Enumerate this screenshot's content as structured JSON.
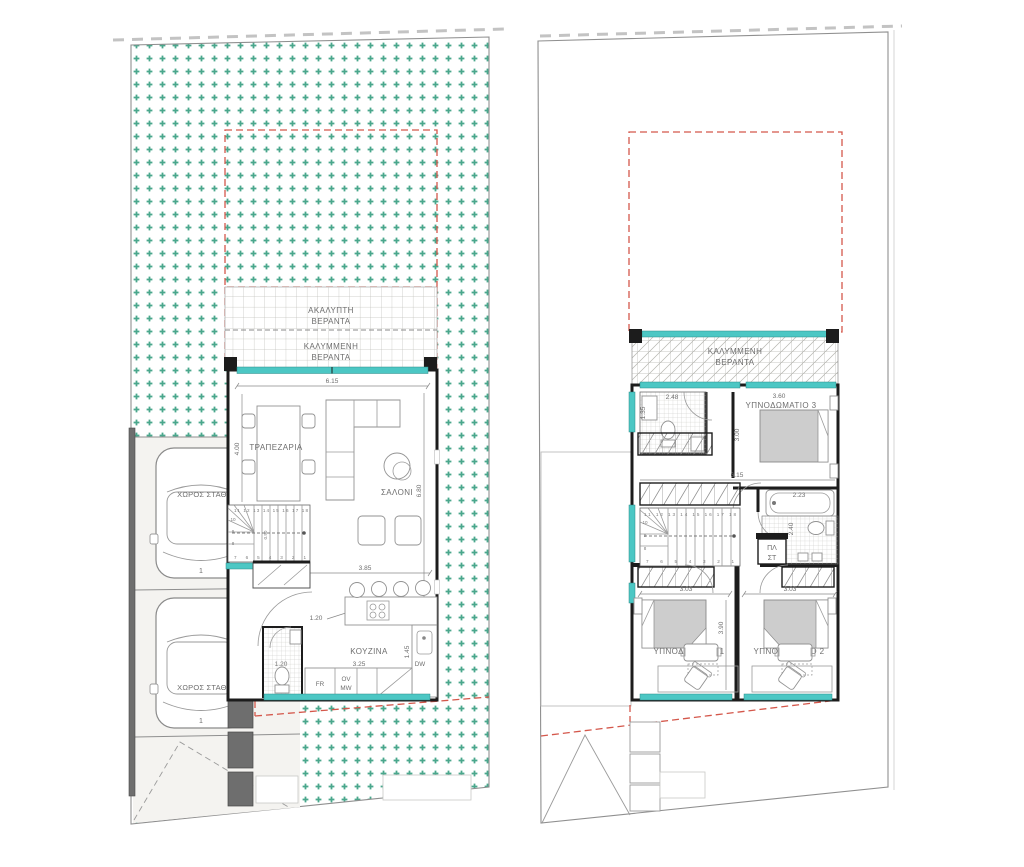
{
  "colors": {
    "garden_dots": "#4aa78c",
    "glazing_teal": "#4cc7c4",
    "upper_floor_outline_red": "#d4574b",
    "walls_black": "#1c1c1c",
    "boundary_wall_gray": "#6e6e6e"
  },
  "ground_floor": {
    "veranda_uncovered": [
      "ΑΚΑΛΥΠΤΗ",
      "ΒΕΡΑΝΤΑ"
    ],
    "veranda_covered": [
      "ΚΑΛΥΜΜΕΝΗ",
      "ΒΕΡΑΝΤΑ"
    ],
    "dining_label": "ΤΡΑΠΕΖΑΡΙΑ",
    "living_label": "ΣΑΛΟΝΙ",
    "kitchen_label": "ΚΟΥΖΙΝΑ",
    "parking_label_1": "ΧΩΡΟΣ ΣΤΑΘΜΕΥΣΗΣ",
    "parking_label_2": "ΧΩΡΟΣ ΣΤΑΘΜΕΥΣΗΣ",
    "car_number_1": "1",
    "car_number_2": "1",
    "fridge": "FR",
    "oven": "OV",
    "microwave": "MW",
    "dishwasher": "DW",
    "dim_top_width": "6.15",
    "dim_dining_depth": "4.00",
    "dim_living_depth": "6.80",
    "dim_kitchen_zone": "3.85",
    "dim_hall_width": "1.20",
    "dim_counter_width": "3.25",
    "dim_counter_depth": "1.45",
    "dim_wc_width": "1.20",
    "dim_stair_width": "0.90",
    "stairs": {
      "top_row": "11 12 13 14 15 16 17 18",
      "left_col": [
        "10",
        "9",
        "8"
      ],
      "bottom_row": "7 6 5 4 3 2 1"
    }
  },
  "first_floor": {
    "veranda_covered": [
      "ΚΑΛΥΜΜΕΝΗ",
      "ΒΕΡΑΝΤΑ"
    ],
    "bedroom3_label": "ΥΠΝΟΔΩΜΑΤΙΟ 3",
    "bedroom1_label": "ΥΠΝΟΔΩΜΑΤΙΟ 1",
    "bedroom2_label": "ΥΠΝΟΔΩΜΑΤΙΟ 2",
    "laundry": [
      "ΠΛ",
      "ΣΤ"
    ],
    "dim_shower_width": "2.48",
    "dim_shower_depth": "1.35",
    "dim_bedroom3_width": "3.60",
    "dim_bedroom3_depth": "3.00",
    "dim_interior_width": "6.15",
    "dim_bath_width": "2.23",
    "dim_bath_depth": "2.40",
    "dim_bedroom1_width": "3.03",
    "dim_bedroom2_width": "3.03",
    "dim_bedrooms_depth": "3.90",
    "stairs": {
      "top_row": "11 12 13 14 15 16 17 18",
      "left_col": [
        "10",
        "9",
        "8"
      ],
      "bottom_row": "7 6 5 4 3 2 1"
    }
  }
}
